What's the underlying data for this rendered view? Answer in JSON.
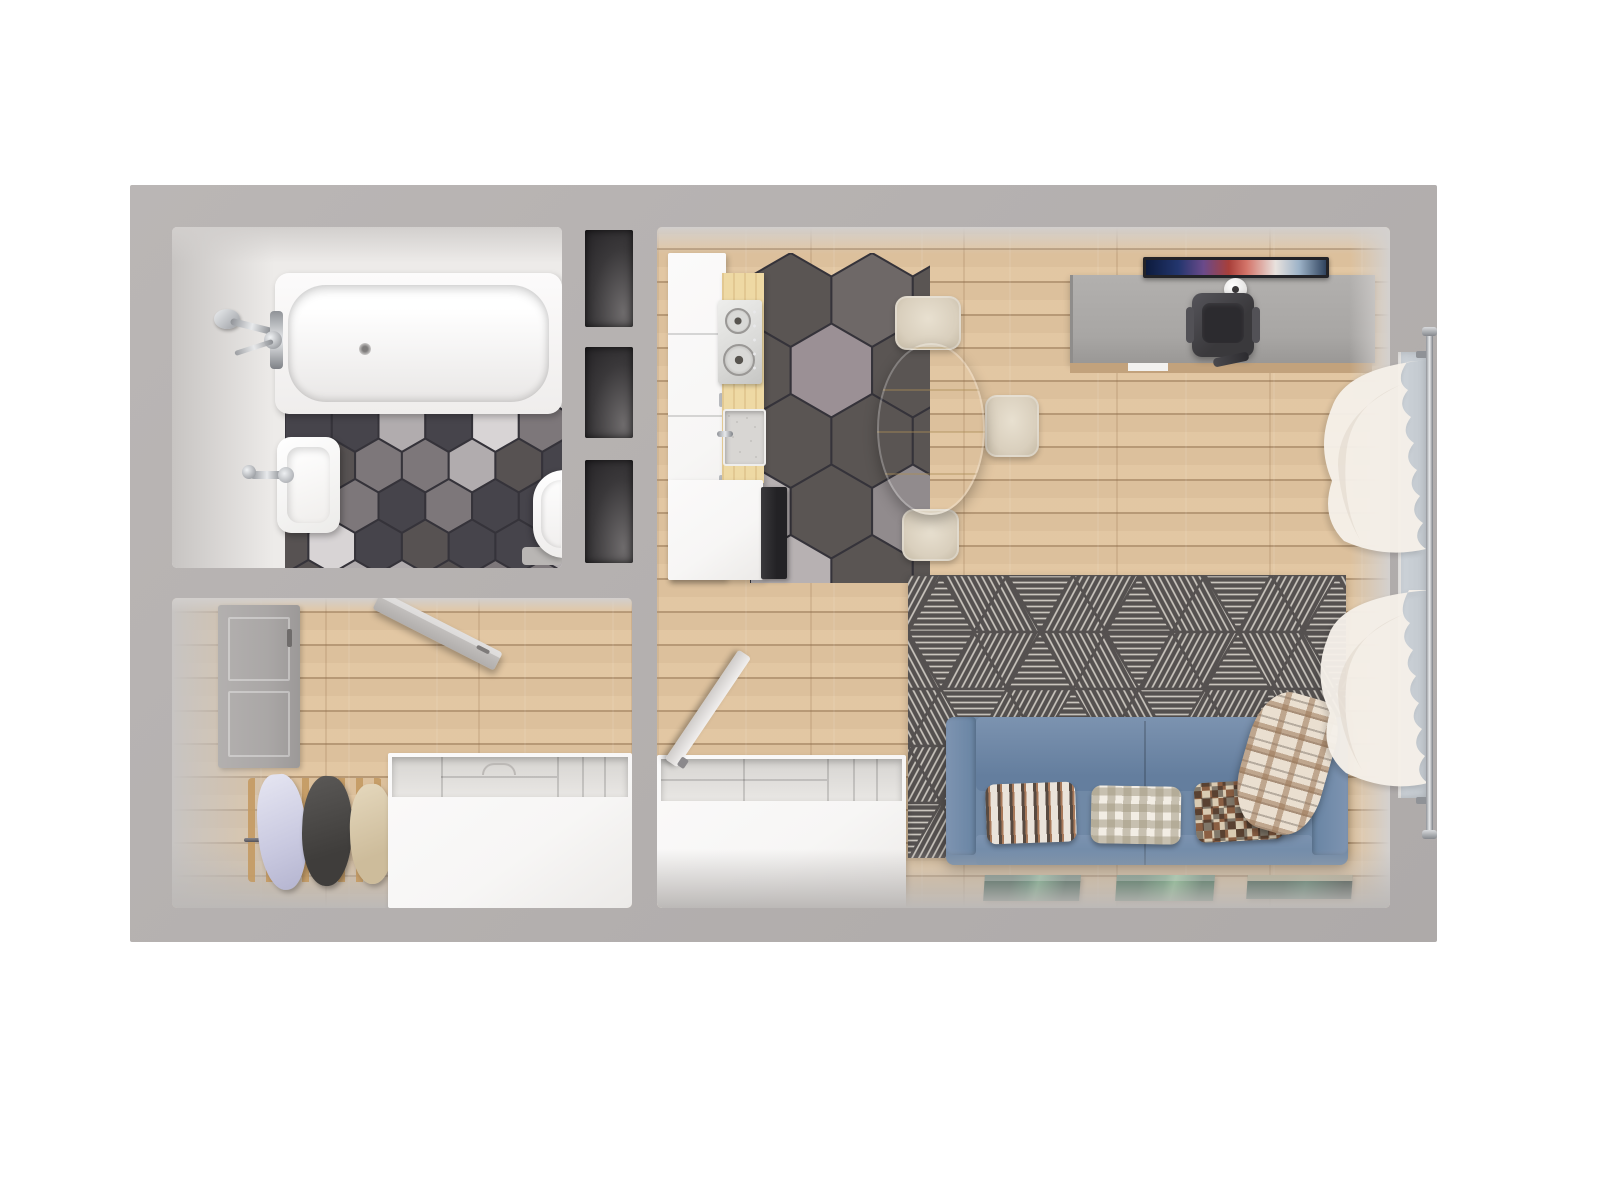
{
  "meta": {
    "type": "3d-floorplan-render",
    "view": "top-down",
    "label": "one-bedroom apartment 3D floor plan, no visible text"
  },
  "palette": {
    "background": "#ffffff",
    "wall": "#b5b1b0",
    "room_face": "#edebe9",
    "wood_floor": "#dcc09c",
    "wood_line": "#c0a078",
    "counter_wood": "#eed9a4",
    "cabinet_white": "#f7f6f5",
    "appliance_black": "#232225",
    "steel": "#d9d9d7",
    "chrome": "#b9bcc0",
    "rug_base": "#555150",
    "rug_line": "#cbc6bf",
    "sofa_blue": "#7089a6",
    "sofa_blue_dark": "#647e9e",
    "sofa_seat": "#7c93b0",
    "table_wood": "#eed8a6",
    "chair_cream": "#d9cfbd",
    "desk_gray": "#a8a6a4",
    "plant_green": "#4f8c3c",
    "curtain_white": "#f5f0e9",
    "window_glass": "#ccd2d8",
    "door_gray": "#aaa7a6",
    "rack_wood": "#c49a62",
    "canvas_green_1": "#2e6f4f",
    "canvas_green_2": "#3f8a58",
    "canvas_green_3": "#1a402f",
    "blanket_cream": "#eadfd0",
    "blanket_brown": "#9b7757",
    "pillow_white": "#eae3da",
    "pillow_check": "#b3aa97",
    "pillow_mosaic_brown": "#8a5f43",
    "screen_colors": [
      "#14234d",
      "#6a4a8a",
      "#a83f3a",
      "#e0d8d4"
    ]
  },
  "tiles": {
    "bathroom": [
      "#46444b",
      "#d8d4d5",
      "#7d777a",
      "#46444b",
      "#b1acae",
      "#575252",
      "#46444b",
      "#7d777a",
      "#575252",
      "#d8d4d5",
      "#46444b",
      "#b1acae"
    ],
    "kitchen": [
      "#5a5553",
      "#6e6867",
      "#5a5553",
      "#918b8d",
      "#5a5553",
      "#b7b1b2",
      "#6e6867",
      "#5a5553",
      "#9b9095",
      "#5a5553",
      "#7b7474",
      "#5a5553"
    ]
  },
  "inventory": {
    "bathroom": [
      "bathtub",
      "shower-mixer",
      "washbasin",
      "toilet",
      "hexagon-tile-floor"
    ],
    "wall_niches": [
      "niche",
      "niche",
      "niche"
    ],
    "hallway": [
      "entry-door",
      "open-door",
      "coat-rack",
      "hanging-clothes",
      "open-top-wardrobe"
    ],
    "living_kitchen": [
      "kitchen-cabinets",
      "wood-countertop",
      "gas-hob",
      "kitchen-sink",
      "black-appliance",
      "hexagon-tile-floor",
      "dining-table",
      "dining-chair",
      "dining-chair",
      "dining-chair",
      "potted-plant",
      "desk",
      "monitor",
      "desk-lamp",
      "desk-chair",
      "geometric-rug",
      "sofa",
      "patterned-pillow",
      "gingham-pillow",
      "mosaic-pillow",
      "plaid-throw",
      "green-canvas-print",
      "green-canvas-print",
      "green-canvas-print",
      "open-top-wardrobe",
      "leaning-board",
      "window",
      "sheer-curtain",
      "sheer-curtain",
      "curtain-rod"
    ]
  }
}
